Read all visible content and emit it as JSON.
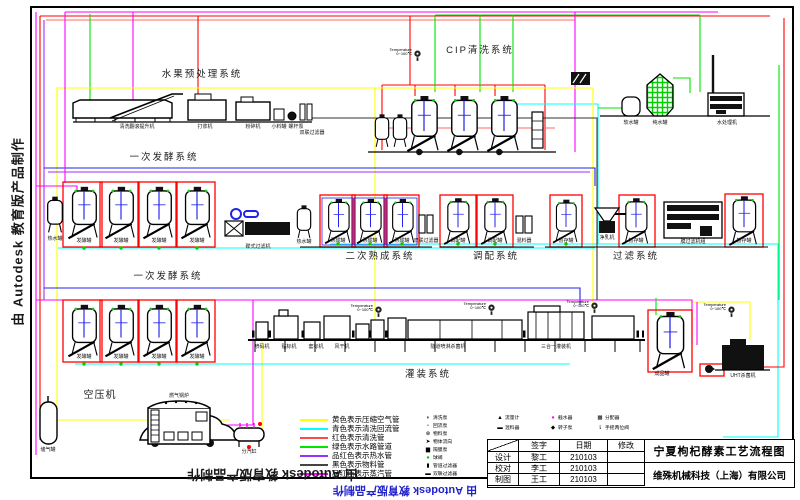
{
  "doc": {
    "title": "宁夏枸杞酵素工艺流程图",
    "company": "维殊机械科技（上海）有限公司"
  },
  "watermark": {
    "left": "由 Autodesk 教育版产品制作",
    "bottom": "由 Autodesk 教育版产品制作",
    "bottom_blue": "由 Autodesk 教育版产品制作"
  },
  "systems": {
    "fruit": "水果预处理系统",
    "cip": "CIP清洗系统",
    "ferment1": "一次发酵系统",
    "ferment2": "一次发酵系统",
    "secondary": "二次熟成系统",
    "blend": "调配系统",
    "filter": "过滤系统",
    "filling": "灌装系统",
    "air": "空压机",
    "boiler": "燃气锅炉"
  },
  "equipment": {
    "wash_lift": "清洗翻滚提升机",
    "pulper": "打浆机",
    "crusher": "粉碎机",
    "small_tank": "小料罐",
    "screw_pump": "螺杆泵",
    "duplex_filter": "双联过滤器",
    "soft_tank": "软水罐",
    "pure_tank": "纯水罐",
    "water_machine": "水处理机",
    "hot_tank": "热水罐",
    "ferment_tank": "发酵罐",
    "disc_filter": "碟式过滤机",
    "mature_tank": "熟成罐",
    "blend_tank": "调配罐",
    "mixer": "混料器",
    "buffer_tank": "暂存罐",
    "clarifier": "净乳机",
    "membrane": "膜过滤机组",
    "coder": "喷码机",
    "labeler": "贴标机",
    "sleever": "套标机",
    "dryer": "风干机",
    "tunnel": "隧道喷淋杀菌机",
    "filler": "三合一灌装机",
    "product_tank": "成品罐",
    "sterilizer": "UHT杀菌机",
    "air_tank": "储气罐",
    "steam_header": "分汽缸"
  },
  "gauge": {
    "line1": "Temperature",
    "line2": "0~100℃"
  },
  "legend": {
    "lines": [
      {
        "style": "background:#ffff00",
        "label": "黄色表示压缩空气管"
      },
      {
        "style": "background:#00ffff",
        "label": "青色表示清洗回流管"
      },
      {
        "style": "background:#ff4a4a",
        "label": "红色表示清洗管"
      },
      {
        "style": "background:#00e400",
        "label": "绿色表示水路管道"
      },
      {
        "style": "background:#9a30ff",
        "label": "品红色表示热水管"
      },
      {
        "style": "background:#444444",
        "label": "黑色表示物料管"
      },
      {
        "style": "background:#ff00ff",
        "label": "品红色表示蒸汽管"
      }
    ],
    "col1": [
      {
        "glyph": "◗",
        "label": "清洗泵"
      },
      {
        "glyph": "▪",
        "label": "回流泵"
      },
      {
        "glyph": "⊗",
        "label": "物料泵"
      },
      {
        "glyph": "➤",
        "label": "物体流向"
      },
      {
        "glyph": "▆",
        "label": "隔膜泵"
      },
      {
        "glyph": "●",
        "label": "球阀"
      },
      {
        "glyph": "▮",
        "label": "管道过滤器"
      },
      {
        "glyph": "▬",
        "label": "双联过滤器"
      }
    ],
    "col2": [
      {
        "glyph": "▲",
        "label": "流量计"
      },
      {
        "glyph": "▬",
        "label": "混料器"
      }
    ],
    "col3": [
      {
        "glyph": "●",
        "label": "截水器"
      },
      {
        "glyph": "◆",
        "label": "转子泵"
      }
    ],
    "col4": [
      {
        "glyph": "▩",
        "label": "分配器"
      },
      {
        "glyph": "⇂",
        "label": "手摇两位阀"
      }
    ]
  },
  "title_block": {
    "h_sign": "签字",
    "h_date": "日期",
    "h_mod": "修改",
    "r1c": "设计",
    "r1n": "黎工",
    "r1d": "210103",
    "r2c": "校对",
    "r2n": "李工",
    "r2d": "210103",
    "r3c": "制图",
    "r3n": "王工",
    "r3d": "210103"
  },
  "colors": {
    "compressed_air": "#ffff00",
    "cip_return": "#00ffff",
    "cip_supply": "#ff0000",
    "water": "#00e400",
    "hot_water": "#9a30ff",
    "material": "#000000",
    "steam": "#ff00ff"
  }
}
